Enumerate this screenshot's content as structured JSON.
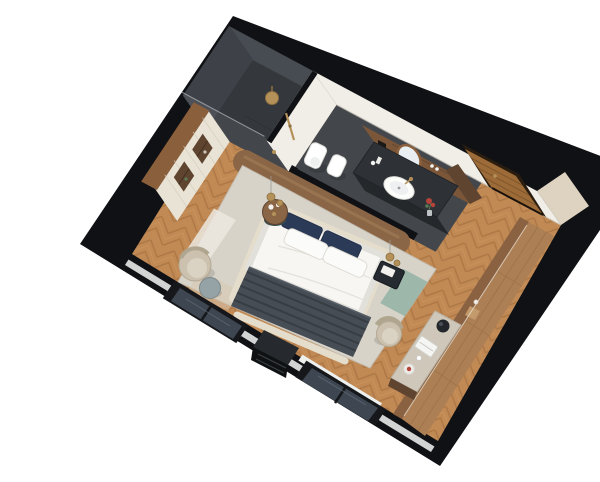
{
  "scene": {
    "kind": "3d-cutaway-floorplan-render",
    "room": "hotel-bedroom-suite",
    "areas": [
      "bedroom",
      "walk-in-shower",
      "wc",
      "vanity",
      "entry-hall"
    ],
    "furniture": [
      "double-bed",
      "upholstered-headboard",
      "wood-feature-wall",
      "pendant-lights",
      "round-nightstand",
      "square-nightstand",
      "area-rug",
      "lounge-chair",
      "ottoman",
      "wardrobe-with-display-niches",
      "tv-console",
      "window",
      "window",
      "desk",
      "desk-chair",
      "wall-length-wood-console",
      "entrance-door",
      "vanity-counter",
      "vessel-sink",
      "mirror",
      "toilet",
      "bidet",
      "rain-shower-head",
      "shower-glass-panel"
    ],
    "colors": {
      "page-bg": "#ffffff",
      "wall-black": "#101114",
      "wall-white": "#f1eee7",
      "wall-cream": "#ddd3c0",
      "floor-wood": "#c18a55",
      "floor-wood-dark": "#a06c3c",
      "shower-floor": "#34383d",
      "shower-wall": "#3e4248",
      "shower-wall2": "#474c52",
      "bath-floor": "#43474c",
      "wood-panel": "#7b5638",
      "wood-dark": "#5f4430",
      "wood-trim": "#8a5f3c",
      "wardrobe-cream": "#e9e3d6",
      "wood-feature": "#8a6647",
      "door-wood": "#9c6b38",
      "door-frame": "#2a1d10",
      "gold": "#b5915a",
      "duvet": "#f7f6f2",
      "pillow-navy": "#2b3a57",
      "pillow-white": "#fbfbf9",
      "throw": "#474d55",
      "throw-dark": "#2c3136",
      "headboard": "#e6dfcf",
      "bed-frame": "#e5ddcb",
      "rug-base": "#d8d3c9",
      "rug-white": "#ece8e0",
      "rug-teal": "#8fb0a4",
      "rug-beige": "#d8c6ae",
      "nightstand-dark": "#262b31",
      "nightstand-teal": "#3a4d50",
      "chair-beige": "#cbc1ae",
      "chair-seat": "#dad2c2",
      "ottoman": "#95a3a7",
      "window-frame": "#15171a",
      "window-glass": "#3e4651",
      "sill-white": "#eef0ee",
      "console-wood": "#ad7f55",
      "console-face": "#8a6242",
      "console-light": "#c39a6b",
      "console-line": "#946b43",
      "desk-top": "#cfc8ba",
      "counter-dark": "#2e3236",
      "sink-white": "#fdfdfc",
      "plant": "#5a7a52",
      "flower-red": "#b5443a"
    }
  }
}
